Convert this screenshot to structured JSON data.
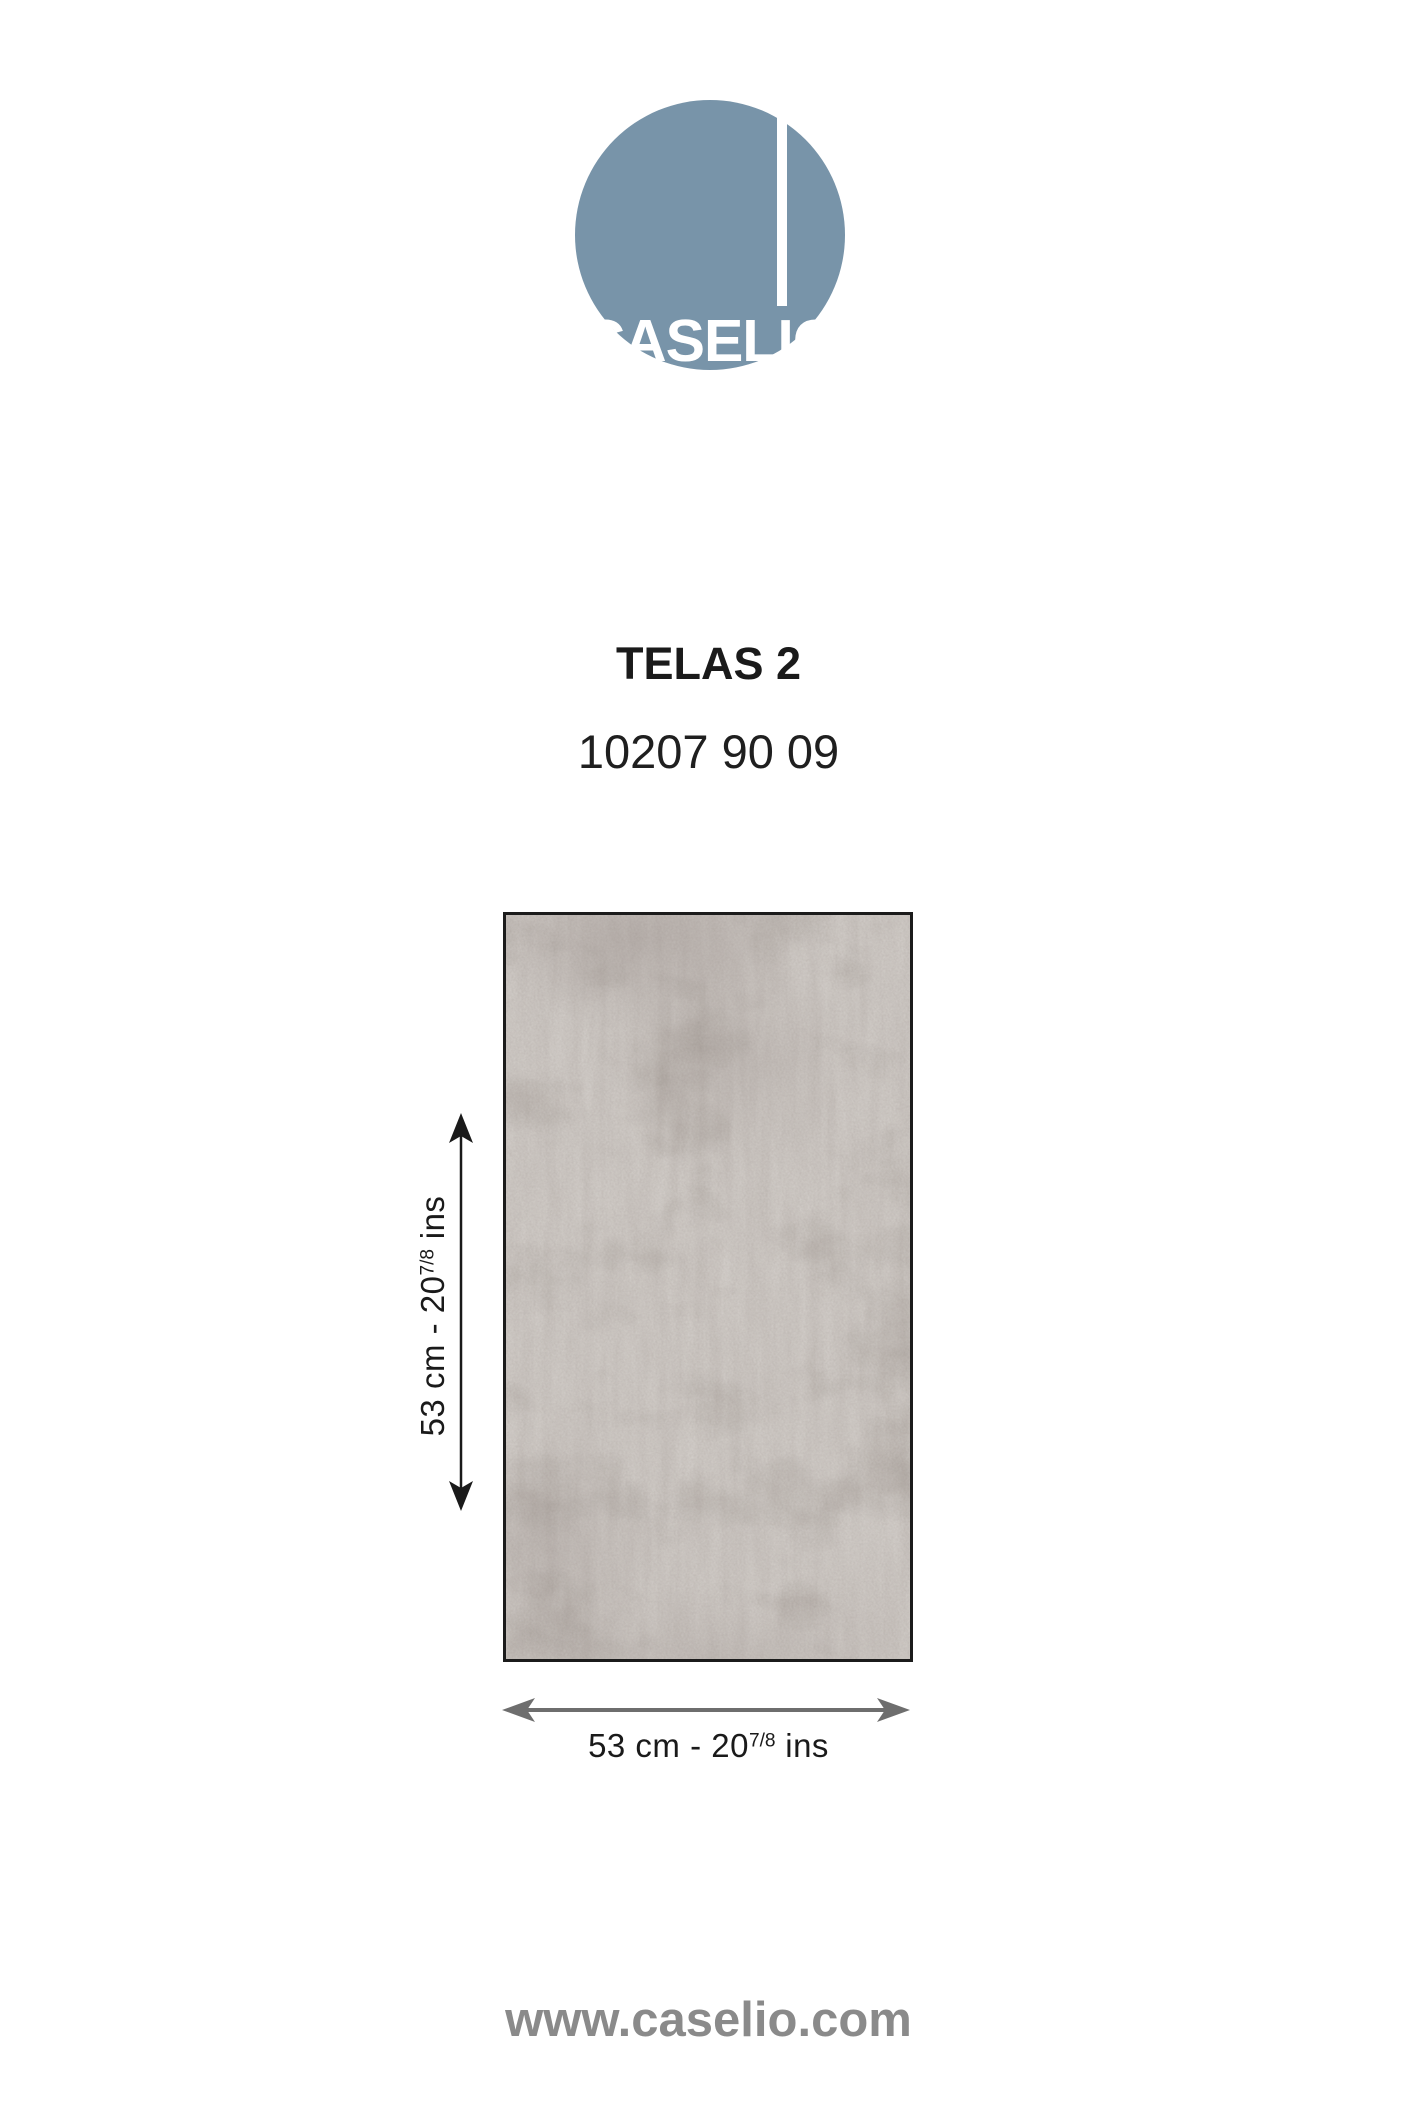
{
  "logo": {
    "text": "CASELIO",
    "circle_color": "#7894a9",
    "text_color": "#ffffff"
  },
  "product": {
    "name": "TELAS 2",
    "reference": "10207 90 09"
  },
  "swatch": {
    "kind": "plain woven-texture wallpaper sample",
    "base_color": "#d8d4d0",
    "patch_color": "#b7b1ac",
    "border_color": "#1b1b1b"
  },
  "dimensions": {
    "height": {
      "prefix": "53 cm - 20",
      "sup": "7/8",
      "suffix": " ins"
    },
    "width": {
      "prefix": "53 cm - 20",
      "sup": "7/8",
      "suffix": " ins"
    },
    "vertical_arrow_color": "#1a1a1a",
    "horizontal_arrow_color": "#6e6e6e"
  },
  "footer": {
    "website": "www.caselio.com",
    "color": "#8a8a8a"
  }
}
